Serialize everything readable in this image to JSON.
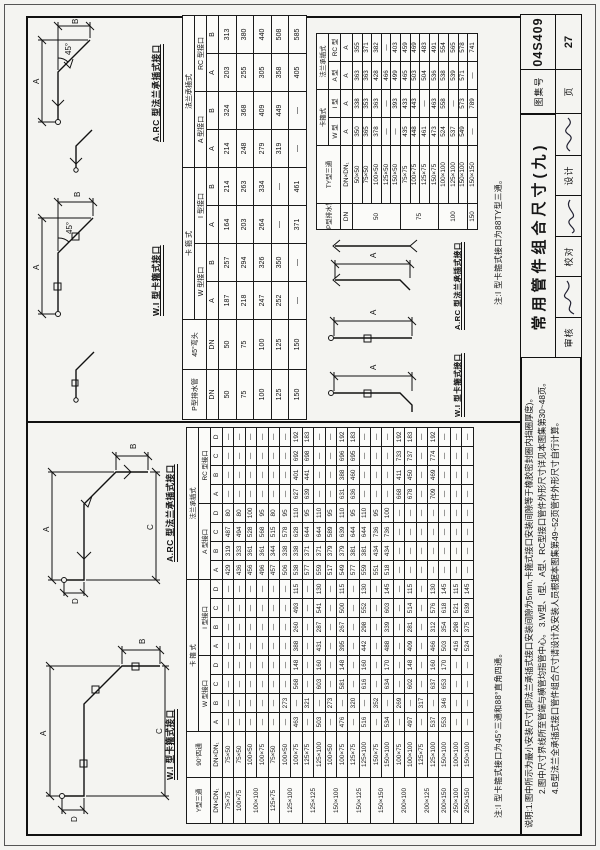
{
  "page": {
    "doc_no": "04S409",
    "page_no": "27",
    "title": "常用管件组合尺寸(九)",
    "atlas_label": "图集号",
    "page_label": "页",
    "reviewer_label": "审核",
    "checker_label": "校对",
    "designer_label": "设计"
  },
  "notes": {
    "left": "注:I 型卡箍式接口为45°三通和88°直角四通。",
    "right": "注:I 型卡箍式接口为88TY型三通。"
  },
  "remarks": {
    "line1": "说明:1.图中所示为最小安装尺寸(即法兰承插式接口安装间隙为5mm,卡箍式接口安装间隙等于橡胶密封圈内挡圈厚度)。",
    "line2": "2.图中尺寸界线所至管端与横管均指管中心。 3.W型、I型、A型、RC型接口管件外形尺寸详见本图集第30~48页。",
    "line3": "4.B型法兰全承插式接口管件组合尺寸请设计及安装人员根据本图集第49~52页管件外形尺寸自行计算。"
  },
  "diagrams": {
    "wi_caption": "W.I 型卡箍式接口",
    "arc_caption": "A.RC 型法兰承插式接口",
    "dim_a": "A",
    "dim_b": "B",
    "dim_c": "C",
    "dim_d": "D",
    "angle": "45°"
  },
  "big_table": {
    "colw": [
      46,
      46,
      19,
      19,
      19,
      19,
      19,
      19,
      19,
      19,
      19,
      19,
      19,
      19,
      19,
      19,
      19,
      19
    ],
    "header": [
      [
        {
          "t": "Y型三通",
          "rs": 2
        },
        {
          "t": "90°四通",
          "rs": 2
        },
        {
          "t": "卡 箍 式",
          "cs": 8
        },
        {
          "t": "法兰承插式",
          "cs": 8
        }
      ],
      [
        {
          "t": "W 型接口",
          "cs": 4
        },
        {
          "t": "I 型接口",
          "cs": 4
        },
        {
          "t": "A 型接口",
          "cs": 4
        },
        {
          "t": "RC 型接口",
          "cs": 4
        }
      ],
      [
        "DN×DN₁",
        "DN×DN₁",
        "A",
        "B",
        "C",
        "D",
        "A",
        "B",
        "C",
        "D",
        "A",
        "B",
        "C",
        "D",
        "A",
        "B",
        "C",
        "D"
      ]
    ],
    "rows": [
      [
        "75×75",
        "75×50",
        "—",
        "—",
        "—",
        "—",
        "—",
        "—",
        "—",
        "—",
        "429",
        "319",
        "487",
        "80",
        "—",
        "—",
        "—",
        "—"
      ],
      [
        "100×75",
        "75×50",
        "—",
        "—",
        "—",
        "—",
        "—",
        "—",
        "—",
        "—",
        "436",
        "333",
        "494",
        "80",
        "—",
        "—",
        "—",
        "—"
      ],
      [
        {
          "t": "100×100",
          "rs": 2
        },
        "100×50",
        "—",
        "—",
        "—",
        "—",
        "—",
        "—",
        "—",
        "—",
        "456",
        "361",
        "528",
        "100",
        "—",
        "—",
        "—",
        "—"
      ],
      [
        "100×75",
        "—",
        "—",
        "—",
        "—",
        "—",
        "—",
        "—",
        "—",
        "496",
        "361",
        "568",
        "95",
        "—",
        "—",
        "—",
        "—"
      ],
      [
        "125×75",
        "75×50",
        "—",
        "—",
        "—",
        "—",
        "—",
        "—",
        "—",
        "—",
        "457",
        "344",
        "515",
        "80",
        "—",
        "—",
        "—",
        "—"
      ],
      [
        {
          "t": "125×100",
          "rs": 2
        },
        "100×50",
        "—",
        "273",
        "—",
        "—",
        "—",
        "—",
        "—",
        "—",
        "506",
        "338",
        "578",
        "95",
        "—",
        "—",
        "—",
        "—"
      ],
      [
        "100×75",
        "463",
        "—",
        "568",
        "148",
        "388",
        "260",
        "493",
        "115",
        "538",
        "338",
        "628",
        "110",
        "627",
        "401",
        "692",
        "192"
      ],
      [
        {
          "t": "125×125",
          "rs": 2
        },
        "125×75",
        "—",
        "321",
        "—",
        "—",
        "—",
        "—",
        "—",
        "—",
        "577",
        "371",
        "644",
        "95",
        "639",
        "441",
        "698",
        "183"
      ],
      [
        "125×100",
        "503",
        "—",
        "603",
        "160",
        "431",
        "287",
        "541",
        "130",
        "559",
        "371",
        "644",
        "110",
        "—",
        "—",
        "—",
        "—"
      ],
      [
        {
          "t": "150×100",
          "rs": 2
        },
        "100×50",
        "—",
        "273",
        "—",
        "—",
        "—",
        "—",
        "—",
        "—",
        "517",
        "379",
        "589",
        "95",
        "—",
        "—",
        "—",
        "—"
      ],
      [
        "100×75",
        "476",
        "—",
        "581",
        "148",
        "395",
        "267",
        "500",
        "115",
        "549",
        "379",
        "639",
        "110",
        "631",
        "388",
        "696",
        "192"
      ],
      [
        {
          "t": "150×125",
          "rs": 2
        },
        "125×75",
        "—",
        "320",
        "—",
        "—",
        "—",
        "—",
        "—",
        "—",
        "577",
        "381",
        "644",
        "95",
        "636",
        "460",
        "695",
        "183"
      ],
      [
        "125×100",
        "516",
        "—",
        "616",
        "160",
        "442",
        "298",
        "552",
        "130",
        "559",
        "381",
        "644",
        "110",
        "—",
        "—",
        "—",
        "—"
      ],
      [
        {
          "t": "150×150",
          "rs": 2
        },
        "150×75",
        "—",
        "352",
        "—",
        "—",
        "—",
        "—",
        "—",
        "—",
        "551",
        "434",
        "736",
        "95",
        "—",
        "—",
        "—",
        "—"
      ],
      [
        "150×100",
        "534",
        "—",
        "634",
        "170",
        "488",
        "339",
        "603",
        "145",
        "518",
        "434",
        "736",
        "100",
        "—",
        "—",
        "—",
        "—"
      ],
      [
        {
          "t": "200×100",
          "rs": 2
        },
        "100×75",
        "—",
        "269",
        "—",
        "—",
        "—",
        "—",
        "—",
        "—",
        "—",
        "—",
        "—",
        "—",
        "668",
        "411",
        "733",
        "192"
      ],
      [
        "100×100",
        "497",
        "—",
        "602",
        "148",
        "409",
        "281",
        "514",
        "115",
        "—",
        "—",
        "—",
        "—",
        "678",
        "450",
        "737",
        "183"
      ],
      [
        {
          "t": "200×125",
          "rs": 2
        },
        "125×75",
        "—",
        "317",
        "—",
        "—",
        "—",
        "—",
        "—",
        "—",
        "—",
        "—",
        "—",
        "—",
        "—",
        "—",
        "—",
        "—"
      ],
      [
        "125×100",
        "537",
        "—",
        "637",
        "160",
        "466",
        "312",
        "576",
        "130",
        "—",
        "—",
        "—",
        "—",
        "709",
        "469",
        "774",
        "192"
      ],
      [
        "200×150",
        "150×100",
        "553",
        "346",
        "653",
        "170",
        "503",
        "354",
        "618",
        "145",
        "—",
        "—",
        "—",
        "—",
        "—",
        "—",
        "—",
        "—"
      ],
      [
        "250×100",
        "100×100",
        "—",
        "—",
        "—",
        "—",
        "416",
        "298",
        "521",
        "115",
        "—",
        "—",
        "—",
        "—",
        "—",
        "—",
        "—",
        "—"
      ],
      [
        "250×150",
        "150×100",
        "—",
        "—",
        "—",
        "—",
        "524",
        "375",
        "639",
        "145",
        "—",
        "—",
        "—",
        "—",
        "—",
        "—",
        "—",
        "—"
      ]
    ]
  },
  "elbow_table": {
    "colw": [
      50,
      50,
      38,
      38,
      38,
      38,
      38,
      38,
      38,
      38
    ],
    "header": [
      [
        {
          "t": "P型排水管",
          "rs": 2
        },
        {
          "t": "45°弯头",
          "rs": 2
        },
        {
          "t": "卡 箍 式",
          "cs": 4
        },
        {
          "t": "法兰承插式",
          "cs": 4
        }
      ],
      [
        {
          "t": "W 型接口",
          "cs": 2
        },
        {
          "t": "I 型接口",
          "cs": 2
        },
        {
          "t": "A 型接口",
          "cs": 2
        },
        {
          "t": "RC 型接口",
          "cs": 2
        }
      ],
      [
        "DN",
        "DN",
        "A",
        "B",
        "A",
        "B",
        "A",
        "B",
        "A",
        "B"
      ]
    ],
    "rows": [
      [
        "50",
        "50",
        "187",
        "257",
        "164",
        "214",
        "214",
        "324",
        "203",
        "313"
      ],
      [
        "75",
        "75",
        "218",
        "294",
        "203",
        "263",
        "248",
        "368",
        "255",
        "380"
      ],
      [
        "100",
        "100",
        "247",
        "326",
        "264",
        "334",
        "279",
        "409",
        "305",
        "440"
      ],
      [
        "125",
        "125",
        "252",
        "350",
        "—",
        "—",
        "319",
        "449",
        "358",
        "508"
      ],
      [
        "150",
        "150",
        "—",
        "—",
        "371",
        "461",
        "—",
        "—",
        "405",
        "585"
      ]
    ]
  },
  "ty_table": {
    "colw": [
      26,
      58,
      28,
      28,
      28,
      28
    ],
    "header": [
      [
        {
          "t": "P型排水管",
          "rs": 2
        },
        {
          "t": "TY型三通",
          "rs": 2
        },
        {
          "t": "卡箍式",
          "cs": 2
        },
        {
          "t": "法兰承插式",
          "cs": 2
        }
      ],
      [
        "W 型",
        "I 型",
        "A 型",
        "RC 型"
      ],
      [
        "DN",
        "DN×DN₁",
        "A",
        "A",
        "A",
        "A"
      ]
    ],
    "rows": [
      [
        {
          "t": "50",
          "rs": 5
        },
        "50×50",
        "350",
        "338",
        "363",
        "355"
      ],
      [
        "75×50",
        "365",
        "353",
        "363",
        "371"
      ],
      [
        "100×50",
        "378",
        "363",
        "428",
        "382"
      ],
      [
        "125×50",
        "—",
        "—",
        "466",
        "—"
      ],
      [
        "150×50",
        "—",
        "393",
        "499",
        "403"
      ],
      [
        {
          "t": "75",
          "rs": 4
        },
        "75×75",
        "435",
        "433",
        "465",
        "459"
      ],
      [
        "100×75",
        "448",
        "443",
        "503",
        "469"
      ],
      [
        "125×75",
        "461",
        "—",
        "504",
        "483"
      ],
      [
        "150×75",
        "473",
        "463",
        "536",
        "491"
      ],
      [
        {
          "t": "100",
          "rs": 3
        },
        "100×100",
        "524",
        "558",
        "538",
        "554"
      ],
      [
        "125×100",
        "537",
        "—",
        "539",
        "565"
      ],
      [
        "150×100",
        "549",
        "573",
        "571",
        "578"
      ],
      [
        "150",
        "150×150",
        "—",
        "789",
        "—",
        "741"
      ]
    ]
  }
}
